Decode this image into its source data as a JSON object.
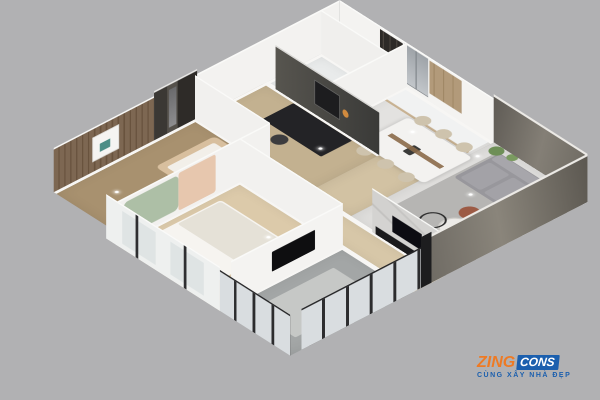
{
  "background_color": "#b1b1b3",
  "render": {
    "description": "3D isometric cutaway render of a two-bedroom apartment floor plan",
    "rooms": [
      "master-bedroom",
      "second-bedroom",
      "study",
      "bathroom",
      "entry",
      "kitchen",
      "dining-area",
      "hallway",
      "living-room",
      "balcony"
    ]
  },
  "watermark": {
    "brand_part1": "ZING",
    "brand_part2": "CONS",
    "tagline": "CÙNG XÂY NHÀ ĐẸP",
    "orange": "#ee7a24",
    "blue": "#1b5fae"
  }
}
